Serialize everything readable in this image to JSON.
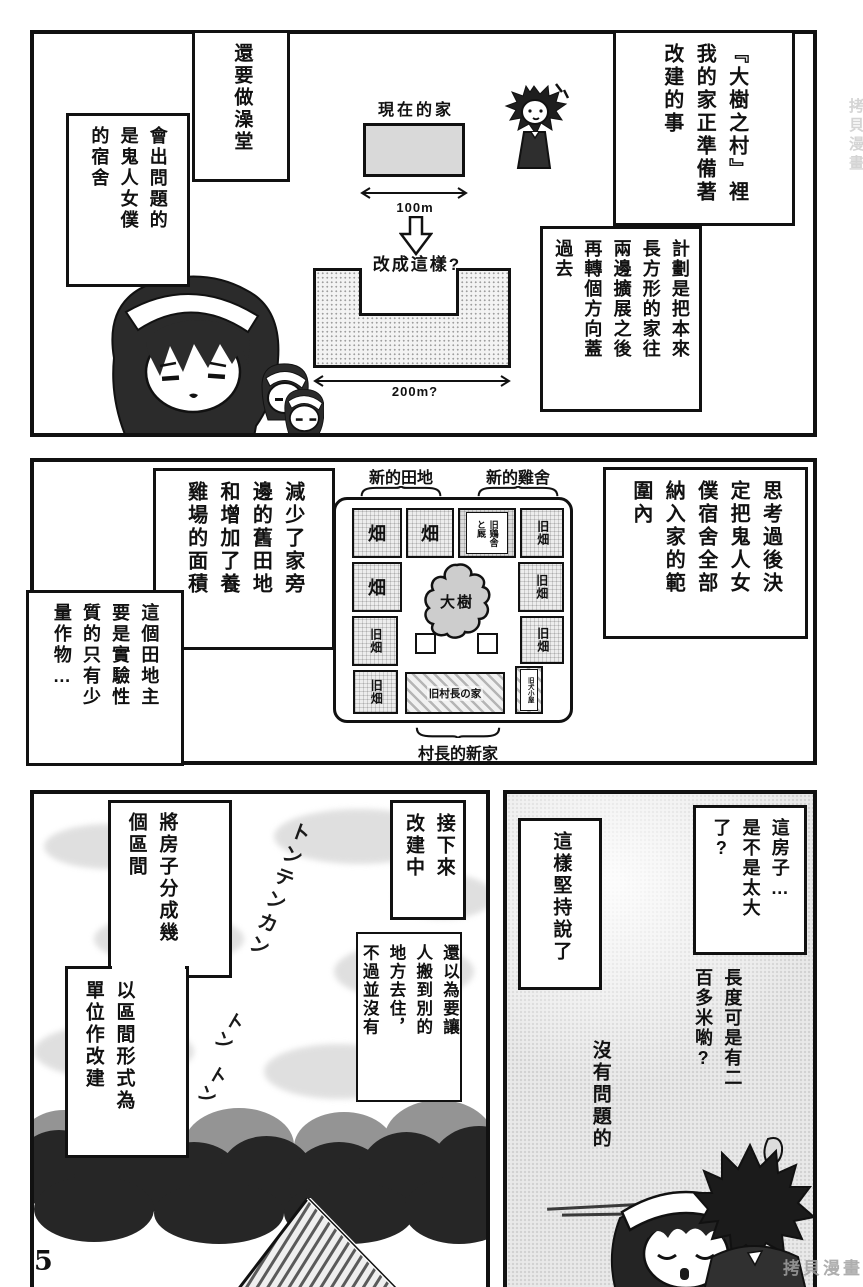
{
  "page": {
    "number": "5",
    "watermark": "拷貝漫畫"
  },
  "p1": {
    "intro": [
      "『大樹之村』裡",
      "我的家正準備著",
      "改建的事"
    ],
    "bath": "還要做澡堂",
    "problem": [
      "會出問題的",
      "是鬼人女僕",
      "的宿舍"
    ],
    "plan": [
      "計劃是把本來",
      "長方形的家往",
      "兩邊擴展之後",
      "再轉個方向蓋",
      "過去"
    ],
    "now_label": "現在的家",
    "now_width": "100m",
    "change_label": "改成這樣?",
    "change_width": "200m?"
  },
  "p2": {
    "decided": [
      "思考過後決",
      "定把鬼人女",
      "僕宿舍全部",
      "納入家的範",
      "圍內"
    ],
    "reduced": [
      "減少了家旁",
      "邊的舊田地",
      "和增加了養",
      "雞場的面積"
    ],
    "experimental": [
      "這個田地主",
      "要是實驗性",
      "質的只有少",
      "量作物…"
    ],
    "map_new_fields": "新的田地",
    "map_new_coop": "新的雞舍",
    "map_new_home": "村長的新家",
    "map_tree": "大樹",
    "map_field": "畑",
    "map_old_field": "旧畑",
    "map_old_coop": [
      "旧鶏舎",
      "と厩"
    ],
    "map_old_home": "旧村長の家",
    "map_old_doghouse": "旧犬小屋"
  },
  "p3": {
    "split_a": [
      "將房子分成幾",
      "個區間"
    ],
    "split_b": [
      "以區間形式為",
      "單位作改建"
    ],
    "next": [
      "接下來",
      "改建中"
    ],
    "thought": [
      "還以為要讓",
      "人搬到別的",
      "地方去住，",
      "不過並沒有"
    ],
    "insist": "這樣堅持說了",
    "too_big": [
      "這房子…",
      "是不是太大",
      "了?"
    ],
    "length": [
      "長度可是有二",
      "百多米喲?"
    ],
    "no_problem": "沒有問題的",
    "sfx_hammer": "トンテンカン",
    "sfx_ton": "トン"
  }
}
